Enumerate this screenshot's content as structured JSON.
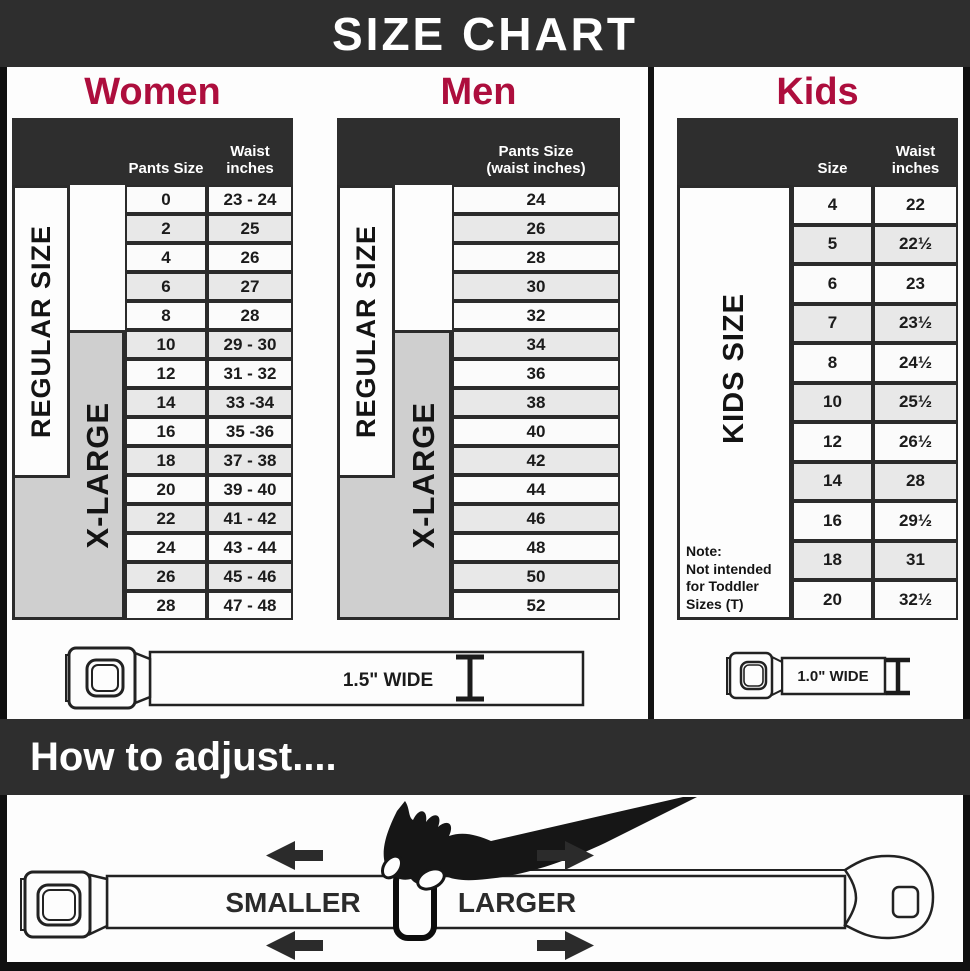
{
  "title": "SIZE CHART",
  "sections": {
    "women": {
      "heading": "Women",
      "col1_header": "Pants Size",
      "col2_header": "Waist inches",
      "regular_label": "REGULAR SIZE",
      "xlarge_label": "X-LARGE",
      "rows": [
        {
          "size": "0",
          "waist": "23 - 24"
        },
        {
          "size": "2",
          "waist": "25"
        },
        {
          "size": "4",
          "waist": "26"
        },
        {
          "size": "6",
          "waist": "27"
        },
        {
          "size": "8",
          "waist": "28"
        },
        {
          "size": "10",
          "waist": "29 - 30"
        },
        {
          "size": "12",
          "waist": "31 - 32"
        },
        {
          "size": "14",
          "waist": "33 -34"
        },
        {
          "size": "16",
          "waist": "35 -36"
        },
        {
          "size": "18",
          "waist": "37 - 38"
        },
        {
          "size": "20",
          "waist": "39 - 40"
        },
        {
          "size": "22",
          "waist": "41 - 42"
        },
        {
          "size": "24",
          "waist": "43 - 44"
        },
        {
          "size": "26",
          "waist": "45 - 46"
        },
        {
          "size": "28",
          "waist": "47 - 48"
        }
      ],
      "belt_width_label": "1.5\" WIDE"
    },
    "men": {
      "heading": "Men",
      "col_header_line1": "Pants Size",
      "col_header_line2": "(waist inches)",
      "regular_label": "REGULAR SIZE",
      "xlarge_label": "X-LARGE",
      "rows": [
        "24",
        "26",
        "28",
        "30",
        "32",
        "34",
        "36",
        "38",
        "40",
        "42",
        "44",
        "46",
        "48",
        "50",
        "52"
      ]
    },
    "kids": {
      "heading": "Kids",
      "col1_header": "Size",
      "col2_header": "Waist inches",
      "kids_label": "KIDS SIZE",
      "note_title": "Note:",
      "note_body": "Not intended for Toddler Sizes (T)",
      "rows": [
        {
          "size": "4",
          "waist": "22"
        },
        {
          "size": "5",
          "waist": "22½"
        },
        {
          "size": "6",
          "waist": "23"
        },
        {
          "size": "7",
          "waist": "23½"
        },
        {
          "size": "8",
          "waist": "24½"
        },
        {
          "size": "10",
          "waist": "25½"
        },
        {
          "size": "12",
          "waist": "26½"
        },
        {
          "size": "14",
          "waist": "28"
        },
        {
          "size": "16",
          "waist": "29½"
        },
        {
          "size": "18",
          "waist": "31"
        },
        {
          "size": "20",
          "waist": "32½"
        }
      ],
      "belt_width_label": "1.0\" WIDE"
    }
  },
  "adjust": {
    "heading": "How to adjust....",
    "smaller_label": "SMALLER",
    "larger_label": "LARGER"
  },
  "colors": {
    "banner": "#2e2e2e",
    "accent": "#ad0e3d",
    "row_alt": "#e8e8e8",
    "xlarge_bg": "#cfcfcf"
  }
}
